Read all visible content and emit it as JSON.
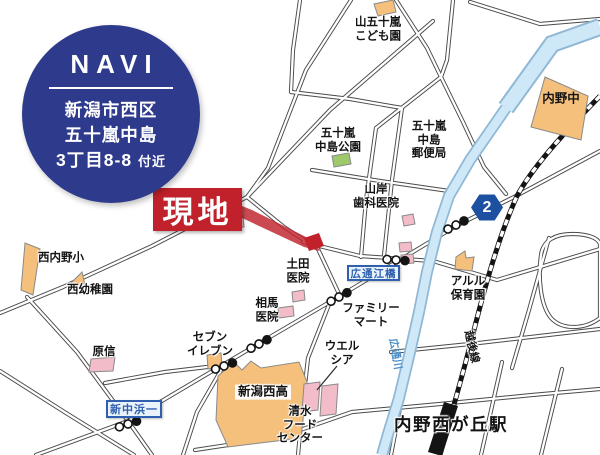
{
  "navi_badge": {
    "title": "NAVI",
    "address_line1": "新潟市西区",
    "address_line2": "五十嵐中島",
    "address_line3": "3丁目8-8",
    "address_line3_suffix": "付近",
    "bg_color": "#2e3a8c"
  },
  "site": {
    "label": "現地",
    "color": "#c0212b"
  },
  "route_badge": {
    "number": "2",
    "color": "#1d50a0"
  },
  "signs": {
    "bridge": "広通江橋",
    "intersection": "新中浜一"
  },
  "railway": {
    "line_label": "越後線",
    "station_label": "内野西が丘駅"
  },
  "river": {
    "label": "広通川"
  },
  "landmarks": {
    "kodomoen": "山五十嵐\nこども園",
    "uchino_jhs": "内野中",
    "nakajima_park": "五十嵐\n中島公園",
    "nakajima_post": "五十嵐\n中島\n郵便局",
    "yamagishi_dental": "山岸\n歯科医院",
    "nishiuchino_elem": "西内野小",
    "nishi_kindergarten": "西幼稚園",
    "arles_nursery": "アルル\n保育園",
    "tsuchida_clinic": "土田\n医院",
    "soma_clinic": "相馬\n医院",
    "familymart": "ファミリー\nマート",
    "welcia": "ウエル\nシア",
    "seven_eleven": "セブン\nイレブン",
    "harashin": "原信",
    "nishi_high": "新潟西高",
    "shimizu_food": "清水\nフード\nセンター"
  },
  "colors": {
    "road_casing": "#4a4a4a",
    "road_fill": "#ffffff",
    "railway": "#141414",
    "river_fill": "#cfe8f7",
    "river_casing": "#8fb8d6",
    "building_public": "#f4c07c",
    "building_commercial": "#f2bcc9",
    "park_green": "#9dc96b",
    "sign_blue": "#2f5fae",
    "site_red": "#c0212b"
  }
}
